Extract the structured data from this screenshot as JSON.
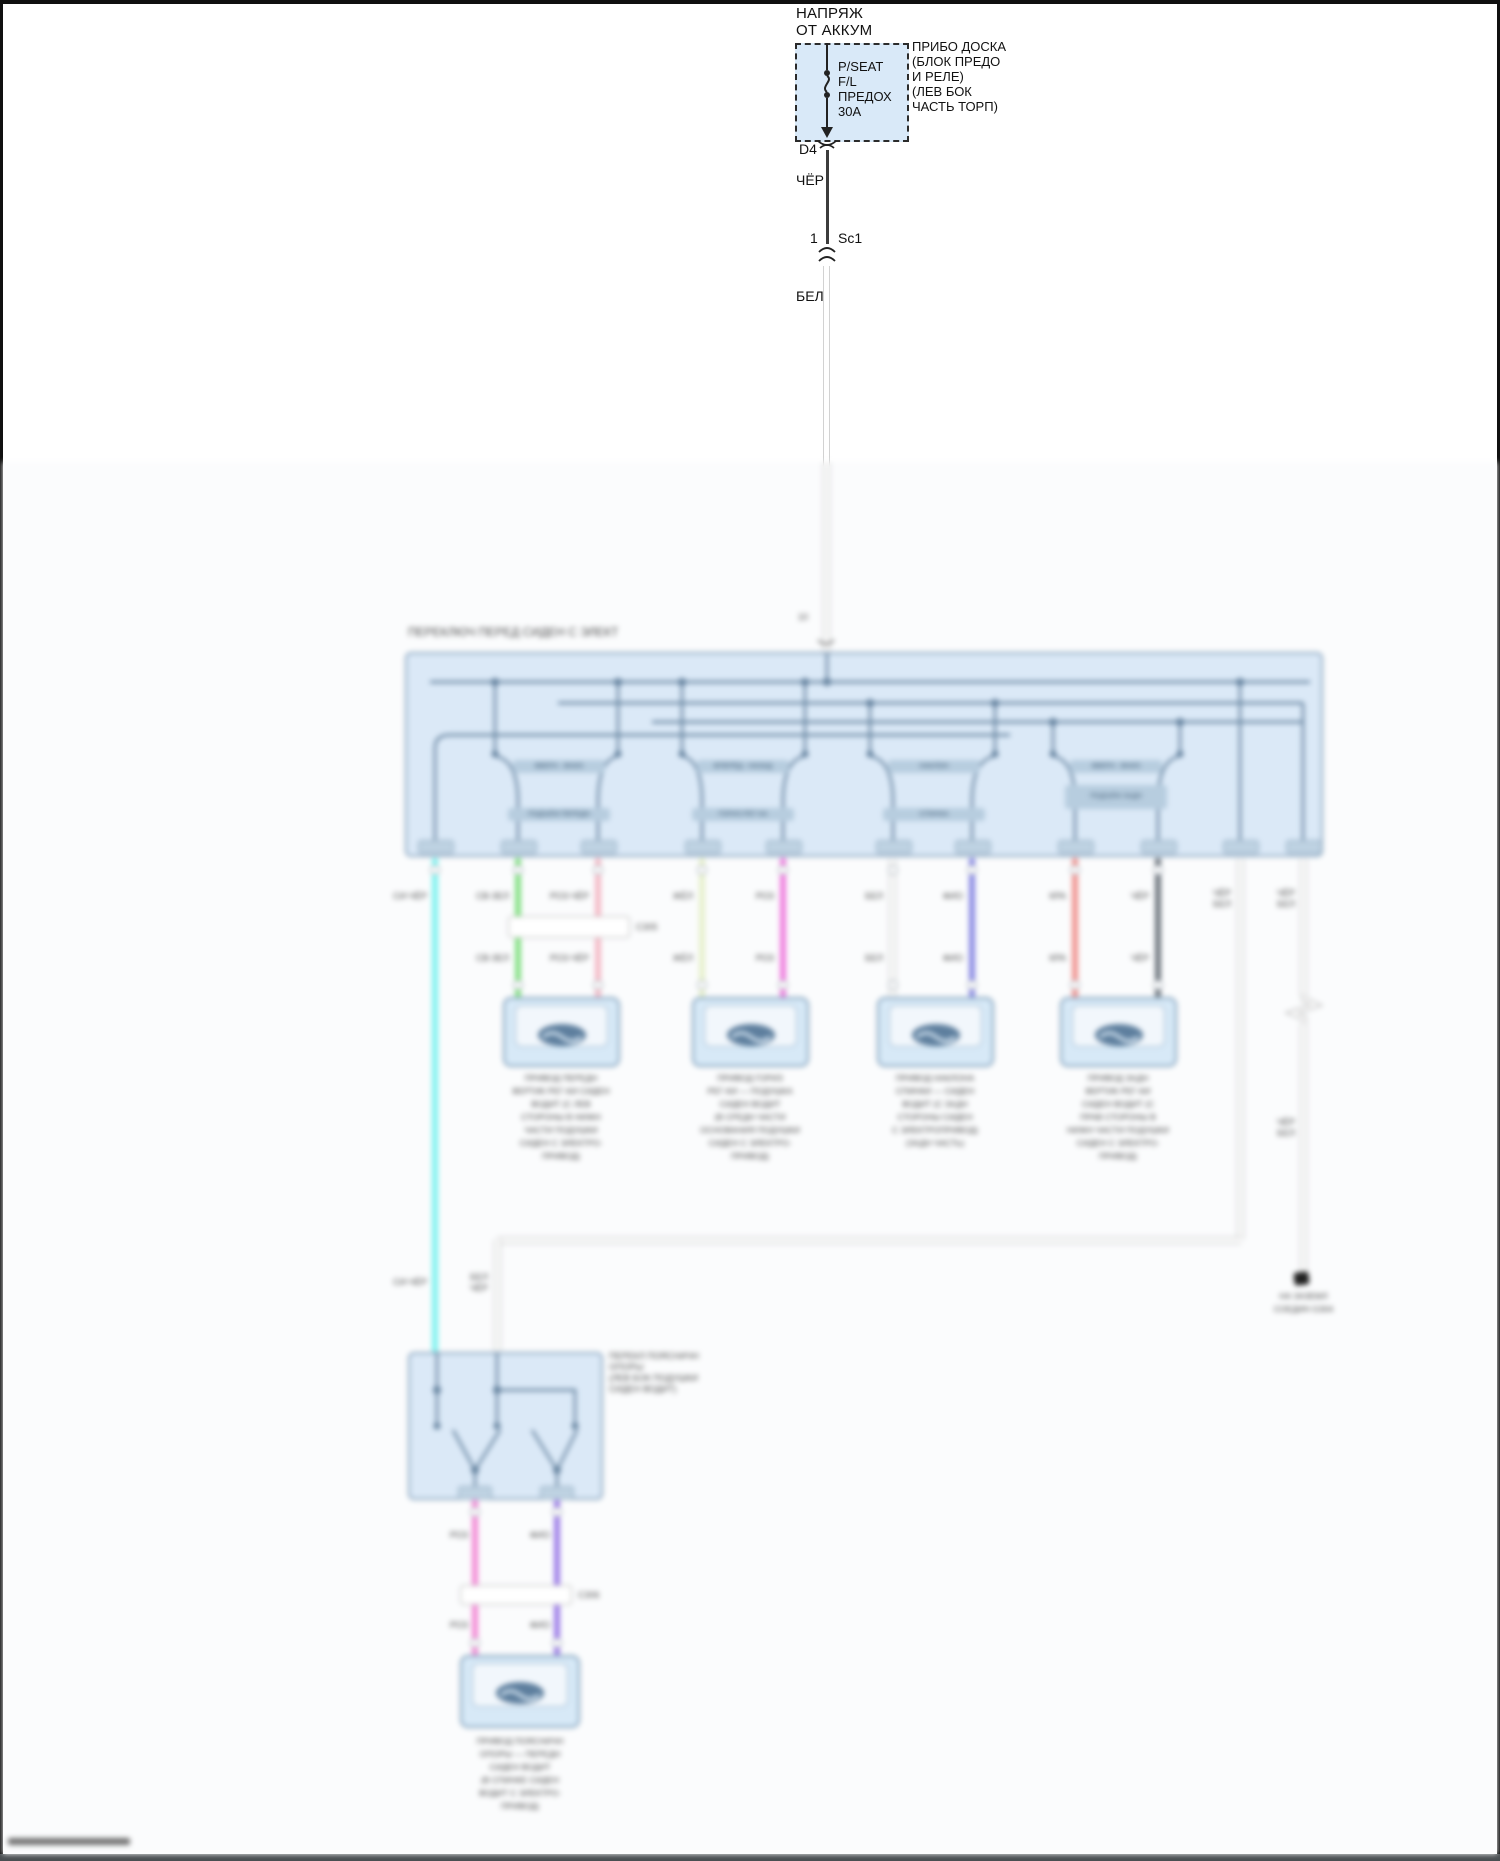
{
  "colors": {
    "block_fill": "#dbe9f7",
    "block_border": "#8ba6bf",
    "diagram_line": "#64829e",
    "wire_cyan": "#7df2ef",
    "wire_lt_green": "#84e084",
    "wire_pink": "#f4b9c6",
    "wire_pale_yellow": "#e6f0cb",
    "wire_rose": "#ef7cde",
    "wire_white": "#ffffff",
    "wire_violet": "#8a8ae4",
    "wire_red": "#f09390",
    "wire_dark": "#6e767e",
    "wire_magenta": "#f38ad6",
    "wire_purple": "#9d7de8",
    "black_wire": "#3c3c3c"
  },
  "top": {
    "feed_line1": "НАПРЯЖ",
    "feed_line2": "ОТ АККУМ",
    "fuse_lines": [
      "P/SEAT",
      "F/L",
      "ПРЕДОХ",
      "30А"
    ],
    "location_lines": [
      "ПРИБО ДОСКА",
      "(БЛОК ПРЕДО",
      "И РЕЛЕ)",
      "(ЛЕВ БОК",
      "ЧАСТЬ ТОРП)"
    ],
    "pin_label": "D4",
    "black_wire_label": "ЧЁР",
    "splice_pin": "1",
    "splice_name": "Sc1",
    "white_wire_label": "БЕЛ"
  },
  "switch_main": {
    "title": "ПЕРЕКЛЮЧ ПЕРЕД СИДЕН С ЭЛЕКТ",
    "entry_pin": "10",
    "chips": {
      "g1_up": "ВВЕРХ - ВНИЗ",
      "g1_low": "ПОДЪЁМ ПЕРЕДН",
      "g2_up": "ВПЕРЁД - НАЗАД",
      "g2_low": "ГОРИЗ РЕГ-КА",
      "g3_up": "НАКЛОН",
      "g3_low": "СПИНКА",
      "g4_up": "ВВЕРХ - ВНИЗ",
      "g4_low": "ПОДЪЁМ ЗАДН"
    }
  },
  "wires": {
    "w1": {
      "label_top": "СИ-ЧЁР",
      "label_bottom": "СИ-ЧЁР",
      "color": "#7df2ef"
    },
    "w2": {
      "label1": "СВ-ЗЕЛ",
      "label2": "СВ-ЗЕЛ",
      "color": "#84e084"
    },
    "w3": {
      "label1": "РОЗ-ЧЁР",
      "label2": "РОЗ-ЧЁР",
      "color": "#f4b9c6"
    },
    "w4": {
      "label1": "ЖЁЛ",
      "label2": "ЖЁЛ",
      "color": "#e6f0cb"
    },
    "w5": {
      "label1": "РОЗ",
      "label2": "РОЗ",
      "color": "#ef7cde"
    },
    "w6": {
      "label1": "БЕЛ",
      "label2": "БЕЛ",
      "color": "#ffffff"
    },
    "w7": {
      "label1": "ФИО",
      "label2": "ФИО",
      "color": "#8a8ae4"
    },
    "w8": {
      "label1": "КРА",
      "label2": "КРА",
      "color": "#f09390"
    },
    "w9": {
      "label1": "ЧЁР",
      "label2": "ЧЁР",
      "color": "#6e767e"
    },
    "w10": {
      "line1": "ЧЁР",
      "line2": "БЕЛ",
      "color": "#ffffff"
    },
    "w11": {
      "line1": "ЧЁР",
      "line2": "БЕЛ",
      "color": "#ffffff"
    },
    "w12": {
      "label1": "РОЗ",
      "label2": "РОЗ",
      "color": "#f38ad6"
    },
    "w13": {
      "label1": "ФИО",
      "label2": "ФИО",
      "color": "#9d7de8"
    }
  },
  "inline_connectors": {
    "c1": "С305",
    "c2": "С306"
  },
  "motors": {
    "m1": {
      "lines": [
        "ПРИВОД ПЕРЕДН",
        "ВЕРТИК РЕГ-КИ СИДЕН",
        "ВОДИТ (С ЛЕВ",
        "СТОРОНЫ В НИЖН",
        "ЧАСТИ ПОДУШКИ",
        "СИДЕН С ЭЛЕКТРО-",
        "ПРИВОД)"
      ]
    },
    "m2": {
      "lines": [
        "ПРИВОД ГОРИЗ",
        "РЕГ-КИ — ПОДУШКА",
        "СИДЕН ВОДИТ",
        "(В СРЕДН ЧАСТИ",
        "ОСНОВАНИЯ ПОДУШКИ",
        "СИДЕН С ЭЛЕКТРО-",
        "ПРИВОД)"
      ]
    },
    "m3": {
      "lines": [
        "ПРИВОД НАКЛОНА",
        "СПИНКИ — СИДЕН",
        "ВОДИТ (С ЗАДН",
        "СТОРОНЫ СИДЕН",
        "С ЭЛЕКТРОПРИВОД)",
        "(ЗАДН ЧАСТЬ)"
      ]
    },
    "m4": {
      "lines": [
        "ПРИВОД ЗАДН",
        "ВЕРТИК РЕГ-КИ",
        "СИДЕН ВОДИТ (С",
        "ПРАВ СТОРОНЫ В",
        "НИЖН ЧАСТИ ПОДУШКИ",
        "СИДЕН С ЭЛЕКТРО-",
        "ПРИВОД)"
      ]
    },
    "m5": {
      "lines": [
        "ПРИВОД ПОЯСНИЧН",
        "ОПОРЫ — ПЕРЕДН",
        "СИДЕН ВОДИТ",
        "(В СПИНКЕ СИДЕН",
        "ВОДИТ С ЭЛЕКТРО-",
        "ПРИВОД)"
      ]
    }
  },
  "switch2": {
    "label_lines": [
      "ПЕРЕКЛ ПОЯСНИЧН",
      "ОПОРЫ",
      "(ЛЕВ БОК ПОДУШКИ",
      "СИДЕН ВОДИТ)"
    ]
  },
  "near_block2_labels": {
    "cyan": "СИ-ЧЁР",
    "white_line1": "БЕЛ",
    "white_line2": "ЧЁР"
  },
  "ground": {
    "caption_line1": "НА ЗАЗЕМЛ",
    "caption_line2": "СОЕДИН G304"
  }
}
